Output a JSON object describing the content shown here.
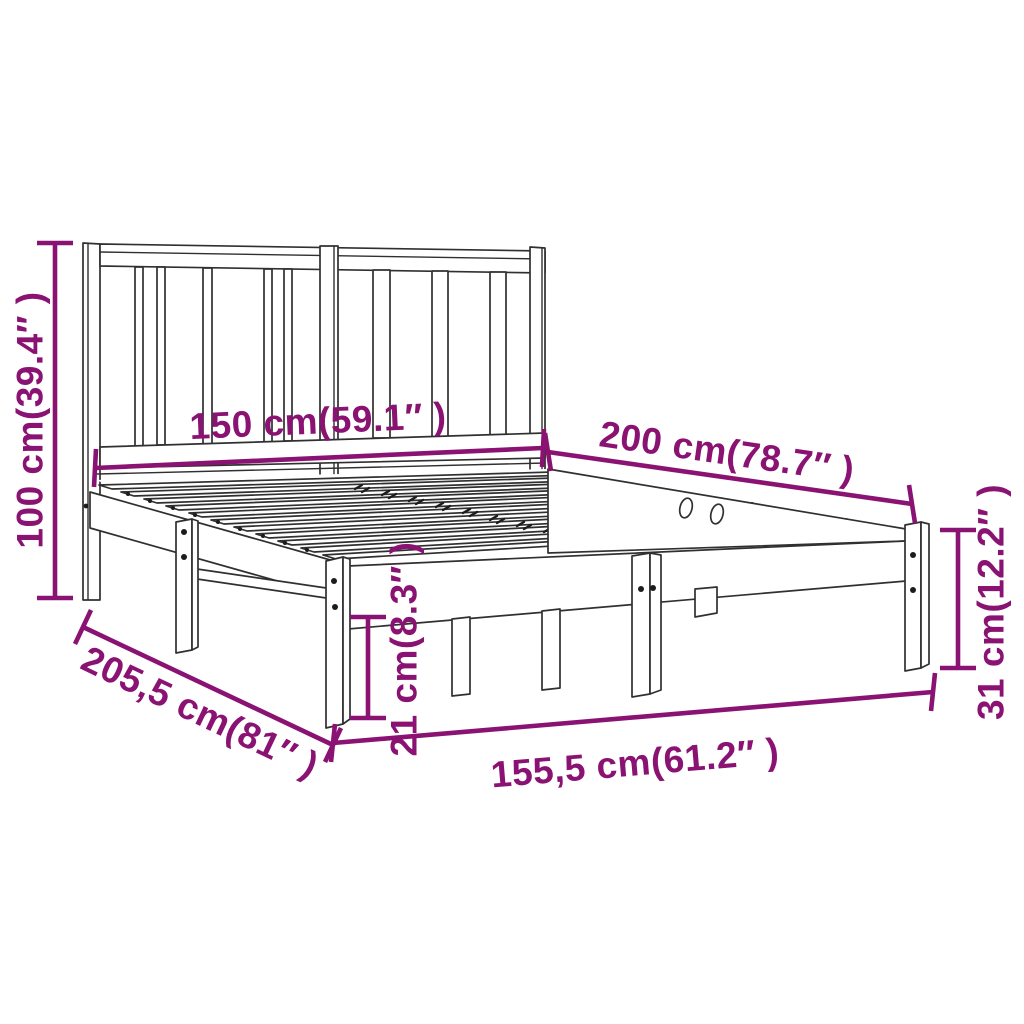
{
  "diagram": {
    "subject": "bed frame with headboard and slatted base",
    "labels": {
      "height": "100 cm(39.4″ )",
      "headboard_width": "150 cm(59.1″ )",
      "length": "200 cm(78.7″ )",
      "side_height": "31 cm(12.2″ )",
      "under_clearance": "21 cm(8.3″ )",
      "total_length": "205,5 cm(81″ )",
      "total_width": "155,5 cm(61.2″ )"
    },
    "colors": {
      "dimension_accent": "#8a1272",
      "line_art": "#303030",
      "background": "#ffffff"
    }
  }
}
